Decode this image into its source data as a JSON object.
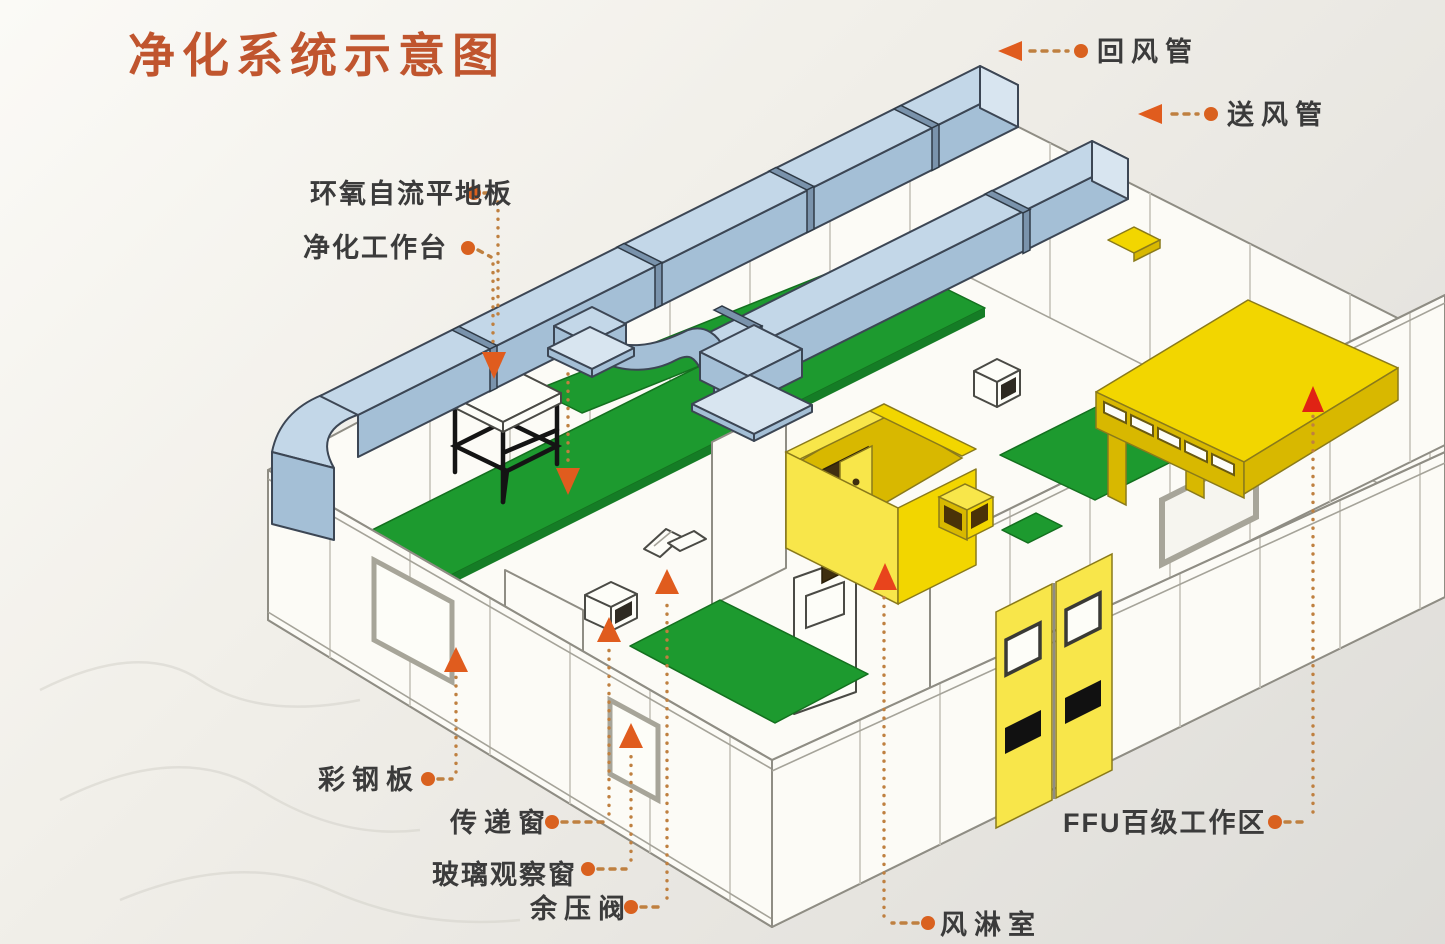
{
  "title": {
    "text": "净化系统示意图"
  },
  "labels": {
    "return_duct": {
      "text": "回风管"
    },
    "supply_duct": {
      "text": "送风管"
    },
    "epoxy_floor": {
      "text": "环氧自流平地板"
    },
    "clean_workbench": {
      "text": "净化工作台"
    },
    "color_steel_panel": {
      "text": "彩钢板"
    },
    "transfer_window": {
      "text": "传递窗"
    },
    "glass_observation_window": {
      "text": "玻璃观察窗"
    },
    "residual_pressure_valve": {
      "text": "余压阀"
    },
    "air_shower": {
      "text": "风淋室"
    },
    "ffu_class100_area": {
      "text": "FFU百级工作区"
    }
  },
  "colors": {
    "title_text": "#c0552e",
    "label_text": "#3b3b3b",
    "leader_line": "#bf8040",
    "leader_dot": "#d9611f",
    "arrow_orange": "#e05c1e",
    "arrow_red": "#e02314",
    "duct_blue": "#c3d7e8",
    "floor_green": "#1d9a2f",
    "equipment_yellow": "#f2d600",
    "wall_white": "#fcfbf6"
  }
}
